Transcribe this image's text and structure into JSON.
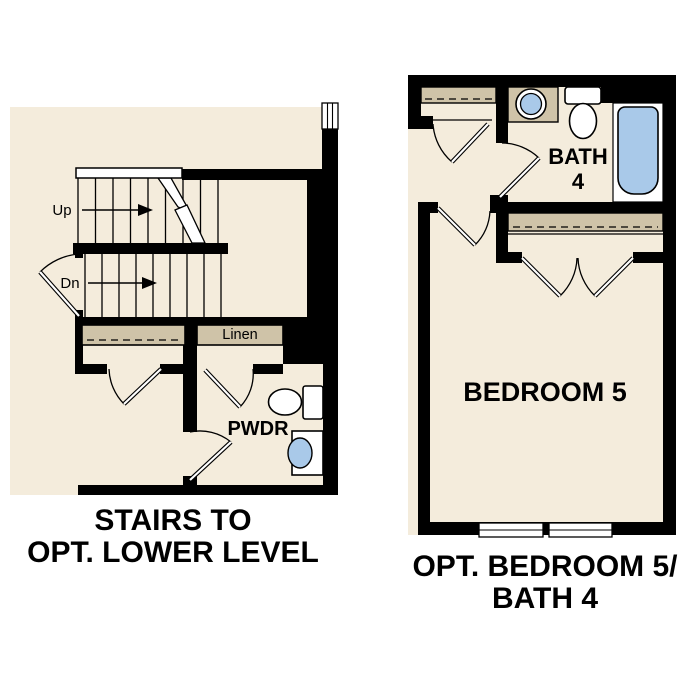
{
  "colors": {
    "floor": "#f4ecdc",
    "shelf": "#cfc3a8",
    "fixture_blue": "#a9c9e9",
    "wall": "#000000",
    "white": "#ffffff"
  },
  "left_plan": {
    "stairs": {
      "up_label": "Up",
      "down_label": "Dn"
    },
    "closets": {
      "linen_label": "Linen"
    },
    "powder_room_label": "PWDR",
    "caption_line1": "STAIRS TO",
    "caption_line2": "OPT. LOWER LEVEL"
  },
  "right_plan": {
    "bath_label_line1": "BATH",
    "bath_label_line2": "4",
    "bedroom_label": "BEDROOM 5",
    "caption_line1": "OPT. BEDROOM 5/",
    "caption_line2": "BATH 4"
  }
}
